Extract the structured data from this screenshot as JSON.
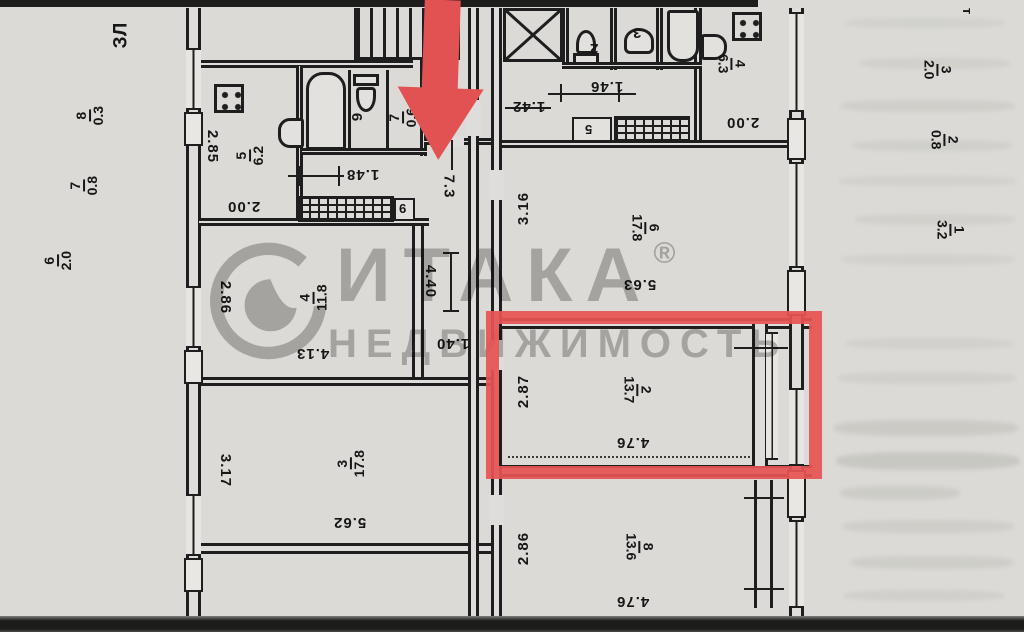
{
  "margins": {
    "corner_left": "ЗЛ",
    "corner_right": "т",
    "left": [
      {
        "num": "8",
        "den": "0.3"
      },
      {
        "num": "7",
        "den": "0.8"
      },
      {
        "num": "6",
        "den": "2.0"
      }
    ],
    "right": [
      {
        "num": "3",
        "den": "2.0"
      },
      {
        "num": "2",
        "den": "0.8"
      },
      {
        "num": "1",
        "den": "3.2"
      }
    ]
  },
  "left_unit": {
    "kitchen": {
      "room": {
        "num": "5",
        "den": "6.2"
      },
      "dim_width": "2.85",
      "dim_bottom": "2.00"
    },
    "san": {
      "wc_label": "6",
      "closet": {
        "num": "7",
        "den": "0.6"
      },
      "dim": "1.48",
      "vent_glyph": "9"
    },
    "corridor": {
      "area": "7.3",
      "dim_length": "4.40",
      "dim_width": "1.40"
    },
    "room4": {
      "room": {
        "num": "4",
        "den": "11.8"
      },
      "dim_width": "2.86",
      "dim_length": "4.13"
    },
    "room3": {
      "room": {
        "num": "3",
        "den": "17.8"
      },
      "dim_width": "3.17",
      "dim_length": "5.62"
    }
  },
  "right_unit": {
    "wc_label": "2",
    "washroom_label": "3",
    "kitchen": {
      "room": {
        "num": "4",
        "den": "6.3"
      },
      "dim_a": "1.46",
      "dim_b": "1.42",
      "dim_c": "2.00",
      "vent_glyph": "5"
    },
    "room6": {
      "room": {
        "num": "6",
        "den": "17.8"
      },
      "dim_width": "3.16",
      "dim_length": "5.63"
    },
    "room2": {
      "room": {
        "num": "2",
        "den": "13.7"
      },
      "dim_width": "2.87",
      "dim_length": "4.76"
    },
    "room8": {
      "room": {
        "num": "8",
        "den": "13.6"
      },
      "dim_width": "2.86",
      "dim_length": "4.76"
    }
  },
  "watermark": {
    "brand": "ИТАКА",
    "reg": "®",
    "subtitle": "НЕДВИЖИМОСТЬ"
  },
  "colors": {
    "highlight": "#e35252",
    "watermark_gray": "#8a8a8a",
    "line": "#1e1e1e"
  }
}
